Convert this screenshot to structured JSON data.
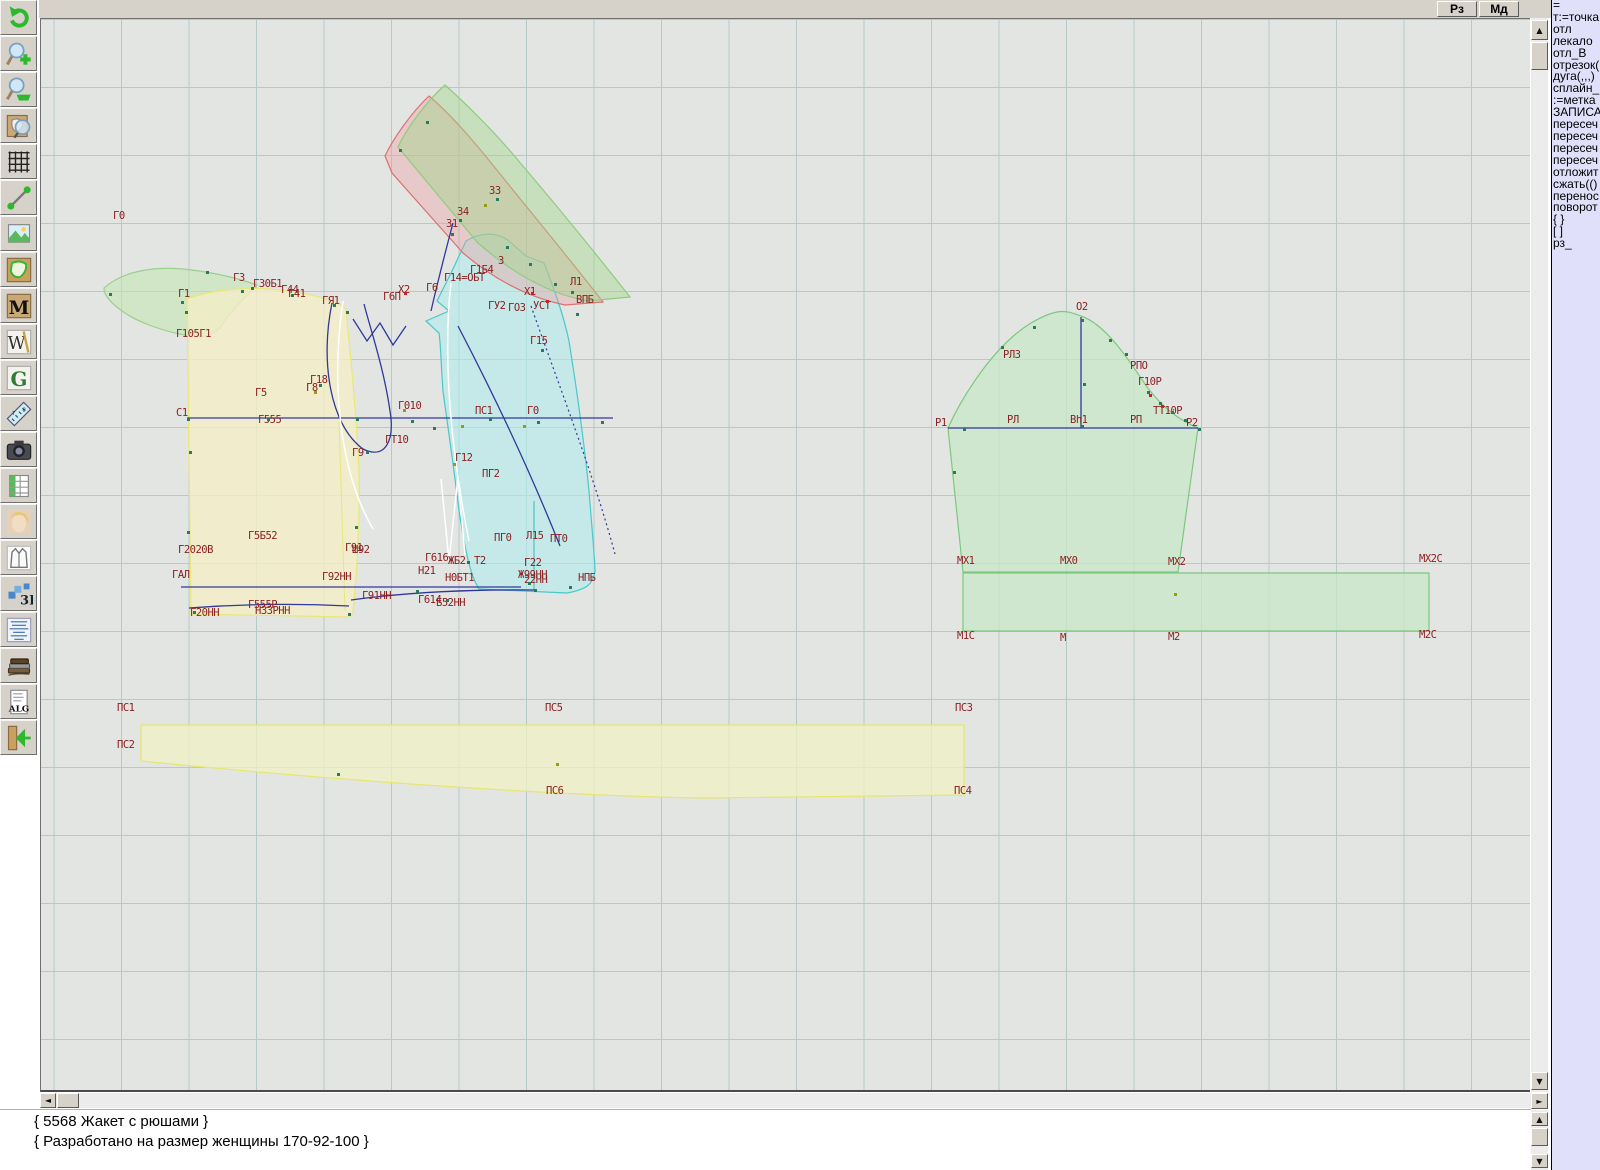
{
  "top_bar": {
    "buttons": [
      {
        "label": "Рз"
      },
      {
        "label": "Мд"
      }
    ]
  },
  "toolbar": {
    "items": [
      {
        "name": "undo-icon"
      },
      {
        "name": "zoom-in-icon"
      },
      {
        "name": "zoom-out-icon"
      },
      {
        "name": "zoom-piece-icon"
      },
      {
        "name": "grid-icon"
      },
      {
        "name": "measure-line-icon"
      },
      {
        "name": "image-icon"
      },
      {
        "name": "pattern-piece-icon"
      },
      {
        "name": "m-letter-icon"
      },
      {
        "name": "w-compass-icon"
      },
      {
        "name": "g-letter-icon"
      },
      {
        "name": "ruler-icon"
      },
      {
        "name": "camera-icon"
      },
      {
        "name": "spreadsheet-icon"
      },
      {
        "name": "portrait-icon"
      },
      {
        "name": "garment-sketch-icon"
      },
      {
        "name": "threed-icon"
      },
      {
        "name": "text-list-icon"
      },
      {
        "name": "books-icon"
      },
      {
        "name": "alg-doc-icon"
      },
      {
        "name": "exit-icon"
      }
    ]
  },
  "panel": {
    "lines": [
      "=",
      "т:=точка",
      "отл",
      "лекало",
      "отл_В",
      "отрезок(",
      "дуга(,,,)",
      "сплайн_",
      ":=метка",
      "ЗАПИСА",
      "пересеч",
      "пересеч",
      "пересеч",
      "пересеч",
      "отложит",
      "сжать(()",
      "перенос",
      "поворот",
      "{ }",
      "[ ]",
      "рз_"
    ]
  },
  "console": {
    "lines": [
      "{ 5568 Жакет с рюшами }",
      "{ Разработано на размер женщины 170-92-100 }"
    ]
  },
  "scroll": {
    "up": "▲",
    "down": "▼",
    "left": "◄",
    "right": "►"
  },
  "canvas": {
    "labels": [
      {
        "t": "Г0",
        "x": 112,
        "y": 209
      },
      {
        "t": "Г1",
        "x": 177,
        "y": 287
      },
      {
        "t": "Г3",
        "x": 232,
        "y": 271
      },
      {
        "t": "Г30Б1",
        "x": 252,
        "y": 277
      },
      {
        "t": "Г44",
        "x": 280,
        "y": 283
      },
      {
        "t": "Г41",
        "x": 287,
        "y": 287
      },
      {
        "t": "ГЯ1",
        "x": 321,
        "y": 294
      },
      {
        "t": "Г105Г1",
        "x": 175,
        "y": 327
      },
      {
        "t": "Г18",
        "x": 309,
        "y": 373
      },
      {
        "t": "Г8",
        "x": 305,
        "y": 381
      },
      {
        "t": "Г5",
        "x": 254,
        "y": 386
      },
      {
        "t": "С1",
        "x": 175,
        "y": 406
      },
      {
        "t": "Г555",
        "x": 257,
        "y": 413
      },
      {
        "t": "З3",
        "x": 488,
        "y": 184
      },
      {
        "t": "З4",
        "x": 456,
        "y": 205
      },
      {
        "t": "З1",
        "x": 445,
        "y": 217
      },
      {
        "t": "Х2",
        "x": 397,
        "y": 283
      },
      {
        "t": "Г6П",
        "x": 382,
        "y": 290
      },
      {
        "t": "Г6",
        "x": 425,
        "y": 281
      },
      {
        "t": "Г14=ОБТ",
        "x": 443,
        "y": 271
      },
      {
        "t": "Г1Б4",
        "x": 469,
        "y": 263
      },
      {
        "t": "З",
        "x": 497,
        "y": 254
      },
      {
        "t": "Х1",
        "x": 523,
        "y": 285
      },
      {
        "t": "ГУ2",
        "x": 487,
        "y": 299
      },
      {
        "t": "ГО3",
        "x": 507,
        "y": 301
      },
      {
        "t": "УСТ",
        "x": 532,
        "y": 299
      },
      {
        "t": "ВПБ",
        "x": 575,
        "y": 293
      },
      {
        "t": "Л1",
        "x": 569,
        "y": 275
      },
      {
        "t": "Г15",
        "x": 529,
        "y": 334
      },
      {
        "t": "Г010",
        "x": 397,
        "y": 399
      },
      {
        "t": "ПС1",
        "x": 474,
        "y": 404
      },
      {
        "t": "Г0",
        "x": 526,
        "y": 404
      },
      {
        "t": "ГТ10",
        "x": 384,
        "y": 433
      },
      {
        "t": "Г9",
        "x": 351,
        "y": 446
      },
      {
        "t": "Г12",
        "x": 454,
        "y": 451
      },
      {
        "t": "ПГ2",
        "x": 481,
        "y": 467
      },
      {
        "t": "Г5Б52",
        "x": 247,
        "y": 529
      },
      {
        "t": "Г2020В",
        "x": 177,
        "y": 543
      },
      {
        "t": "ГАЛ",
        "x": 171,
        "y": 568
      },
      {
        "t": "Г91",
        "x": 344,
        "y": 541
      },
      {
        "t": "Ш92",
        "x": 351,
        "y": 543
      },
      {
        "t": "Г92НН",
        "x": 321,
        "y": 570
      },
      {
        "t": "Г20НН",
        "x": 189,
        "y": 606
      },
      {
        "t": "Г555Р",
        "x": 247,
        "y": 598
      },
      {
        "t": "НЗЗРНН",
        "x": 254,
        "y": 604
      },
      {
        "t": "Г91НН",
        "x": 361,
        "y": 589
      },
      {
        "t": "Г614",
        "x": 417,
        "y": 593
      },
      {
        "t": "Б52НН",
        "x": 435,
        "y": 596
      },
      {
        "t": "ПГ0",
        "x": 493,
        "y": 531
      },
      {
        "t": "Л15",
        "x": 525,
        "y": 529
      },
      {
        "t": "ПТ0",
        "x": 549,
        "y": 532
      },
      {
        "t": "Г616",
        "x": 424,
        "y": 551
      },
      {
        "t": "ЖБ2",
        "x": 447,
        "y": 554
      },
      {
        "t": "Т2",
        "x": 473,
        "y": 554
      },
      {
        "t": "Г22",
        "x": 523,
        "y": 556
      },
      {
        "t": "Н21",
        "x": 417,
        "y": 564
      },
      {
        "t": "Н0БТ1",
        "x": 444,
        "y": 571
      },
      {
        "t": "Ж99НН",
        "x": 517,
        "y": 568
      },
      {
        "t": "22НН",
        "x": 523,
        "y": 573
      },
      {
        "t": "НПБ",
        "x": 577,
        "y": 571
      },
      {
        "t": "О2",
        "x": 1075,
        "y": 300
      },
      {
        "t": "РЛЗ",
        "x": 1002,
        "y": 348
      },
      {
        "t": "РПО",
        "x": 1129,
        "y": 359
      },
      {
        "t": "Г10Р",
        "x": 1137,
        "y": 375
      },
      {
        "t": "ТТ10Р",
        "x": 1152,
        "y": 404
      },
      {
        "t": "Р1",
        "x": 934,
        "y": 416
      },
      {
        "t": "РЛ",
        "x": 1006,
        "y": 413
      },
      {
        "t": "Вh1",
        "x": 1069,
        "y": 413
      },
      {
        "t": "РП",
        "x": 1129,
        "y": 413
      },
      {
        "t": "Р2",
        "x": 1185,
        "y": 416
      },
      {
        "t": "МХ1",
        "x": 956,
        "y": 554
      },
      {
        "t": "МХ0",
        "x": 1059,
        "y": 554
      },
      {
        "t": "МХ2",
        "x": 1167,
        "y": 555
      },
      {
        "t": "МХ2С",
        "x": 1418,
        "y": 552
      },
      {
        "t": "М1С",
        "x": 956,
        "y": 629
      },
      {
        "t": "М",
        "x": 1059,
        "y": 631
      },
      {
        "t": "М2",
        "x": 1167,
        "y": 630
      },
      {
        "t": "М2С",
        "x": 1418,
        "y": 628
      },
      {
        "t": "ПС1",
        "x": 116,
        "y": 701
      },
      {
        "t": "ПС2",
        "x": 116,
        "y": 738
      },
      {
        "t": "ПС5",
        "x": 544,
        "y": 701
      },
      {
        "t": "ПС6",
        "x": 545,
        "y": 784
      },
      {
        "t": "ПС3",
        "x": 954,
        "y": 701
      },
      {
        "t": "ПС4",
        "x": 953,
        "y": 784
      }
    ],
    "dots": [
      [
        108,
        292,
        "g"
      ],
      [
        180,
        300,
        "g"
      ],
      [
        184,
        310,
        "g"
      ],
      [
        205,
        270,
        "g"
      ],
      [
        250,
        286,
        "g"
      ],
      [
        186,
        417,
        "g"
      ],
      [
        266,
        417,
        "g"
      ],
      [
        355,
        417,
        "g"
      ],
      [
        188,
        450,
        "g"
      ],
      [
        240,
        289,
        "g"
      ],
      [
        290,
        293,
        "g"
      ],
      [
        332,
        303,
        "g"
      ],
      [
        345,
        310,
        "g"
      ],
      [
        186,
        530,
        "g"
      ],
      [
        354,
        525,
        "g"
      ],
      [
        192,
        610,
        "g"
      ],
      [
        347,
        612,
        "g"
      ],
      [
        318,
        383,
        "g"
      ],
      [
        365,
        450,
        "g"
      ],
      [
        410,
        419,
        "g"
      ],
      [
        432,
        426,
        "g"
      ],
      [
        488,
        417,
        "g"
      ],
      [
        536,
        420,
        "g"
      ],
      [
        540,
        348,
        "g"
      ],
      [
        575,
        312,
        "g"
      ],
      [
        600,
        420,
        "g"
      ],
      [
        466,
        560,
        "g"
      ],
      [
        415,
        589,
        "g"
      ],
      [
        533,
        588,
        "g"
      ],
      [
        445,
        598,
        "g"
      ],
      [
        527,
        581,
        "g"
      ],
      [
        568,
        585,
        "g"
      ],
      [
        336,
        772,
        "g"
      ],
      [
        425,
        120,
        "g"
      ],
      [
        398,
        148,
        "g"
      ],
      [
        458,
        218,
        "g"
      ],
      [
        450,
        232,
        "g"
      ],
      [
        505,
        245,
        "g"
      ],
      [
        528,
        262,
        "g"
      ],
      [
        553,
        282,
        "g"
      ],
      [
        570,
        290,
        "g"
      ],
      [
        495,
        197,
        "g"
      ],
      [
        1000,
        345,
        "g"
      ],
      [
        1032,
        325,
        "g"
      ],
      [
        1080,
        318,
        "g"
      ],
      [
        1108,
        338,
        "g"
      ],
      [
        1124,
        352,
        "g"
      ],
      [
        1146,
        390,
        "g"
      ],
      [
        1158,
        401,
        "g"
      ],
      [
        1170,
        410,
        "g"
      ],
      [
        1183,
        418,
        "g"
      ],
      [
        952,
        470,
        "g"
      ],
      [
        1080,
        424,
        "g"
      ],
      [
        962,
        427,
        "g"
      ],
      [
        1197,
        427,
        "g"
      ],
      [
        1082,
        382,
        "g"
      ],
      [
        483,
        203,
        "o"
      ],
      [
        313,
        390,
        "o"
      ],
      [
        402,
        408,
        "o"
      ],
      [
        460,
        424,
        "o"
      ],
      [
        522,
        424,
        "o"
      ],
      [
        452,
        462,
        "o"
      ],
      [
        555,
        762,
        "o"
      ],
      [
        1173,
        592,
        "o"
      ],
      [
        530,
        291,
        "r"
      ],
      [
        403,
        291,
        "r"
      ],
      [
        545,
        299,
        "r"
      ],
      [
        1148,
        393,
        "r"
      ],
      [
        1160,
        404,
        "r"
      ]
    ],
    "colors": {
      "label": "#8b2121",
      "navy": "#31389c",
      "grid": "#b7c9c7",
      "bg": "#e3e5e3",
      "piece_yellow": "#f0eec6",
      "piece_green": "#c8e8c6",
      "piece_cyan": "#afe4e4",
      "band_red": "#dd7070",
      "band_green": "#8fcc7f"
    }
  }
}
